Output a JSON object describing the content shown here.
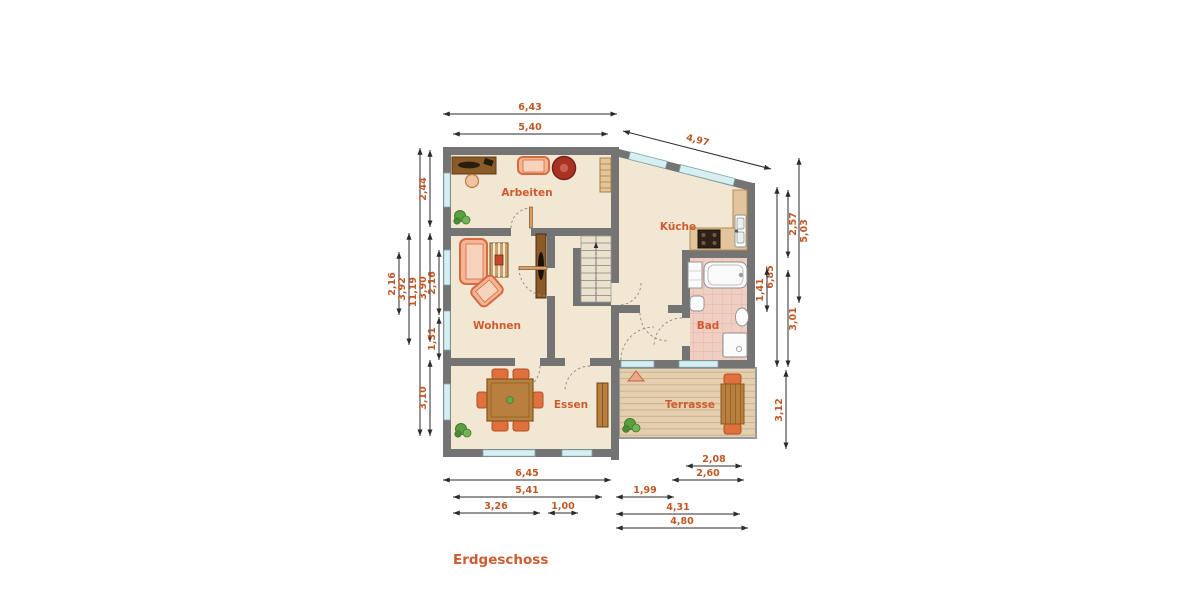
{
  "title": "Erdgeschoss",
  "rooms": {
    "arbeiten": "Arbeiten",
    "kueche": "Küche",
    "wohnen": "Wohnen",
    "bad": "Bad",
    "essen": "Essen",
    "terrasse": "Terrasse"
  },
  "dims": {
    "top": [
      {
        "label": "6,43"
      },
      {
        "label": "5,40"
      },
      {
        "label": "4,97"
      }
    ],
    "left": [
      {
        "label": "2,16"
      },
      {
        "label": "3,92"
      },
      {
        "label": "11,19"
      },
      {
        "label": "2,44"
      },
      {
        "label": "3,90"
      },
      {
        "label": "3,10"
      },
      {
        "label": "2,16"
      },
      {
        "label": "1,31"
      }
    ],
    "right": [
      {
        "label": "5,03"
      },
      {
        "label": "2,57"
      },
      {
        "label": "3,01"
      },
      {
        "label": "6,85"
      },
      {
        "label": "1,41"
      },
      {
        "label": "3,12"
      }
    ],
    "bottom": [
      {
        "label": "6,45"
      },
      {
        "label": "5,41"
      },
      {
        "label": "3,26"
      },
      {
        "label": "1,00"
      },
      {
        "label": "1,99"
      },
      {
        "label": "2,08"
      },
      {
        "label": "2,60"
      },
      {
        "label": "4,31"
      },
      {
        "label": "4,80"
      }
    ]
  },
  "colors": {
    "wall": "#747474",
    "floor": "#f1e7d3",
    "window": "#d8eff1",
    "dimension_text": "#bf5826",
    "room_label_text": "#cf5b30",
    "furniture_orange": "#d96a3f",
    "wood": "#b97f3e",
    "deck": "#e4d0af",
    "bath_tile": "#f0cec2",
    "accent_red": "#a83325",
    "plant_green": "#5d9e43"
  }
}
